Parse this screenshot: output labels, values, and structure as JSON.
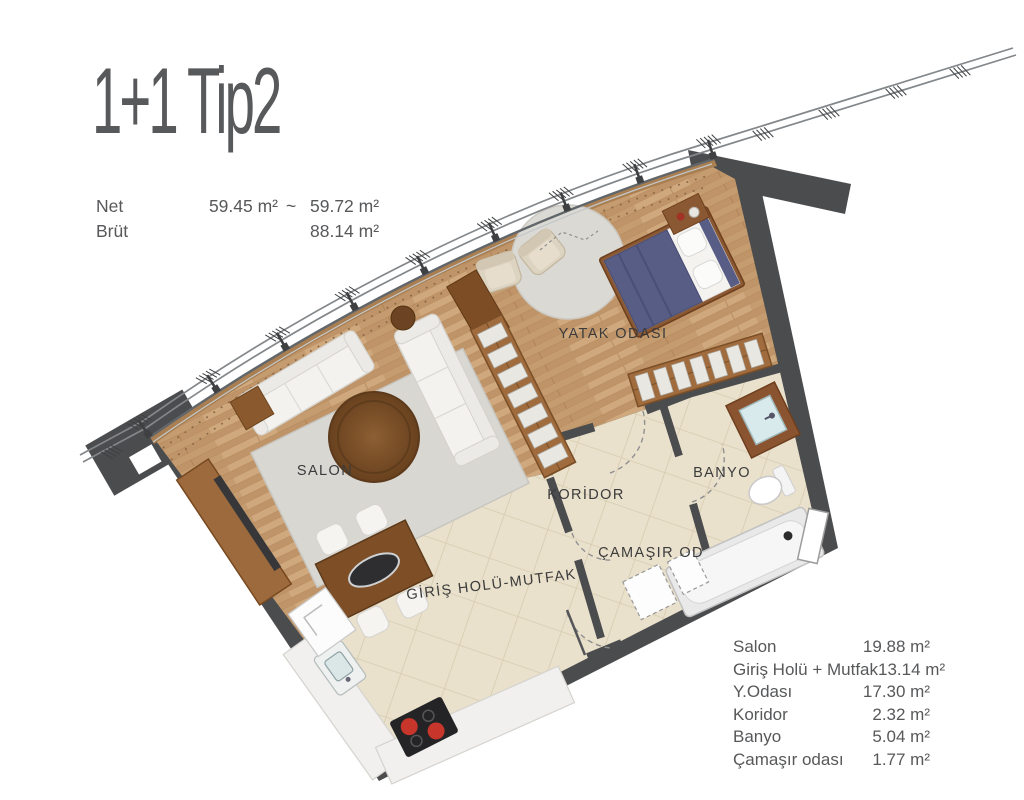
{
  "title": "1+1 Tip2",
  "measurements": {
    "net_label": "Net",
    "net_value_min": "59.45 m²",
    "approx_sign": "~",
    "net_value_max": "59.72 m²",
    "brut_label": "Brüt",
    "brut_value": "88.14 m²"
  },
  "plan": {
    "room_labels": {
      "salon": "SALON",
      "bedroom": "YATAK ODASI",
      "corridor": "KORİDOR",
      "bathroom": "BANYO",
      "laundry": "ÇAMAŞIR OD",
      "entry_kitchen": "GİRİŞ HOLÜ-MUTFAK"
    }
  },
  "area_table": {
    "rows": [
      {
        "label": "Salon",
        "value": "19.88 m²"
      },
      {
        "label": "Giriş Holü + Mutfak",
        "value": "13.14 m²"
      },
      {
        "label": "Y.Odası",
        "value": "17.30 m²"
      },
      {
        "label": "Koridor",
        "value": "2.32 m²"
      },
      {
        "label": "Banyo",
        "value": "5.04 m²"
      },
      {
        "label": "Çamaşır odası",
        "value": "1.77 m²"
      }
    ]
  },
  "colors": {
    "wall": "#4b4c4e",
    "wood_floor": "#c7a077",
    "tile_floor": "#eae1cc",
    "text": "#57585a",
    "bed_navy": "#585d86",
    "rug": "#d9d7d2",
    "counter_white": "#f1f0ee",
    "burner_red": "#c8352b"
  }
}
